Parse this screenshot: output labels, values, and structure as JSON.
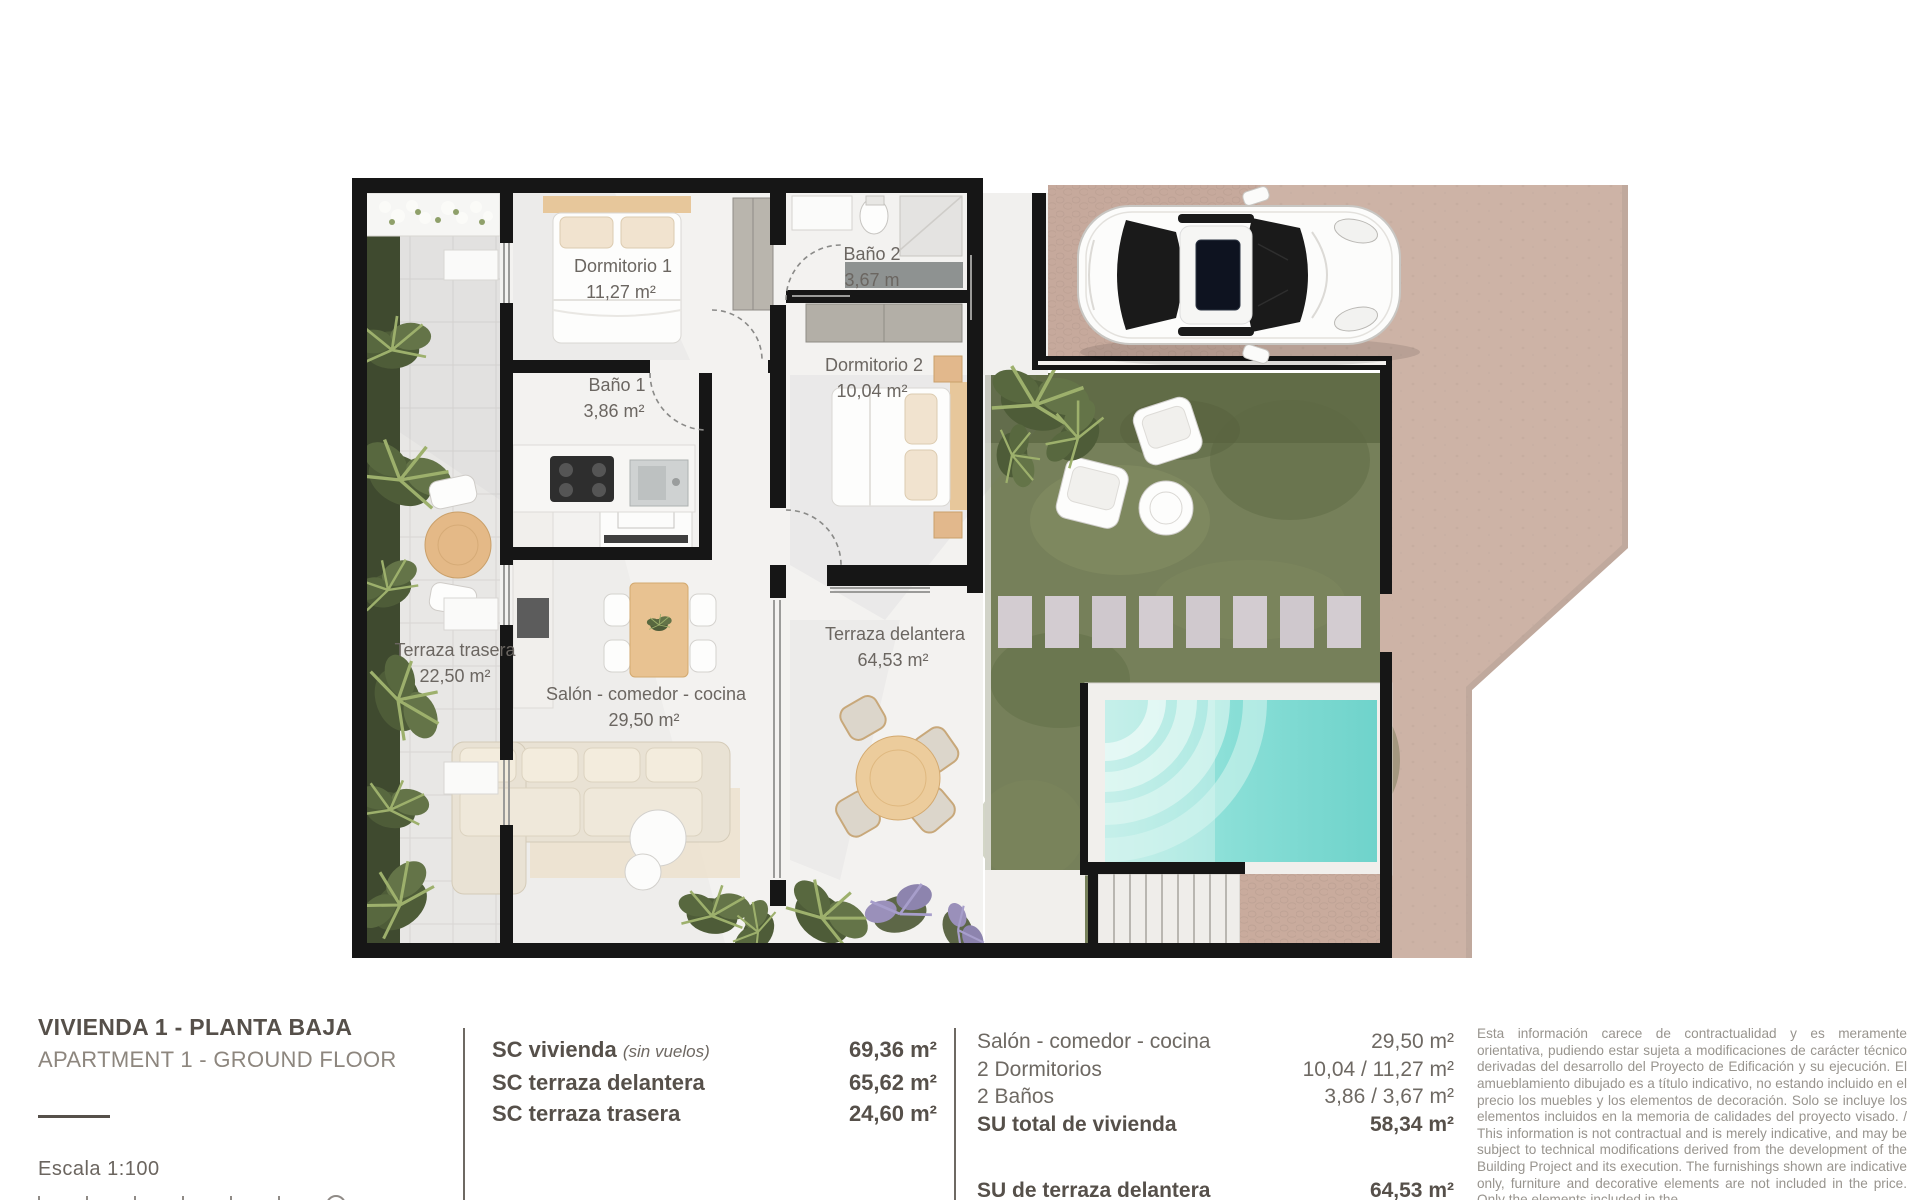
{
  "plan": {
    "labels": [
      {
        "name": "Dormitorio 1",
        "area": "11,27 m²"
      },
      {
        "name": "Baño 2",
        "area": "3,67 m"
      },
      {
        "name": "Baño 1",
        "area": "3,86 m²"
      },
      {
        "name": "Dormitorio 2",
        "area": "10,04 m²"
      },
      {
        "name": "Terraza trasera",
        "area": "22,50 m²"
      },
      {
        "name": "Salón - comedor - cocina",
        "area": "29,50 m²"
      },
      {
        "name": "Terraza delantera",
        "area": "64,53 m²"
      }
    ],
    "features": [
      "pool",
      "garden",
      "car",
      "driveway",
      "stepping-stones",
      "stairs"
    ],
    "colors": {
      "wall": "#161616",
      "garden_green": "#76805a",
      "pool_water": "#74d4cc",
      "driveway_beige": "#cdb3a6",
      "wood_tan": "#e8c291"
    }
  },
  "footer": {
    "title": "VIVIENDA 1 - PLANTA BAJA",
    "subtitle": "APARTMENT 1 - GROUND FLOOR",
    "scale_label": "Escala  1:100",
    "sc_rows": [
      {
        "label": "SC vivienda",
        "note": "(sin vuelos)",
        "value": "69,36 m²"
      },
      {
        "label": "SC terraza delantera",
        "note": "",
        "value": "65,62 m²"
      },
      {
        "label": "SC terraza trasera",
        "note": "",
        "value": "24,60 m²"
      }
    ],
    "su_rows": [
      {
        "label": "Salón - comedor - cocina",
        "value": "29,50 m²"
      },
      {
        "label": "2 Dormitorios",
        "value": "10,04 / 11,27 m²"
      },
      {
        "label": "2 Baños",
        "value": "3,86 / 3,67 m²"
      },
      {
        "label": "SU total de vivienda",
        "value": "58,34 m²"
      },
      {
        "label": "SU de terraza delantera",
        "value": "64,53 m²"
      }
    ],
    "disclaimer": "Esta información carece de contractualidad y es meramente orientativa, pudiendo estar sujeta a modificaciones de carácter técnico derivadas del desarrollo del Proyecto de Edificación y su ejecución. El amueblamiento dibujado es a título indicativo, no estando incluido en el precio los muebles y los elementos de decoración. Solo se incluye los elementos incluidos en la memoria de calidades del proyecto visado. / This information is not contractual and is merely indicative, and may be subject to technical modifications derived from the development of the Building Project and its execution. The furnishings shown are indicative only, furniture and decorative elements are not included in the price. Only the elements included in the"
  }
}
